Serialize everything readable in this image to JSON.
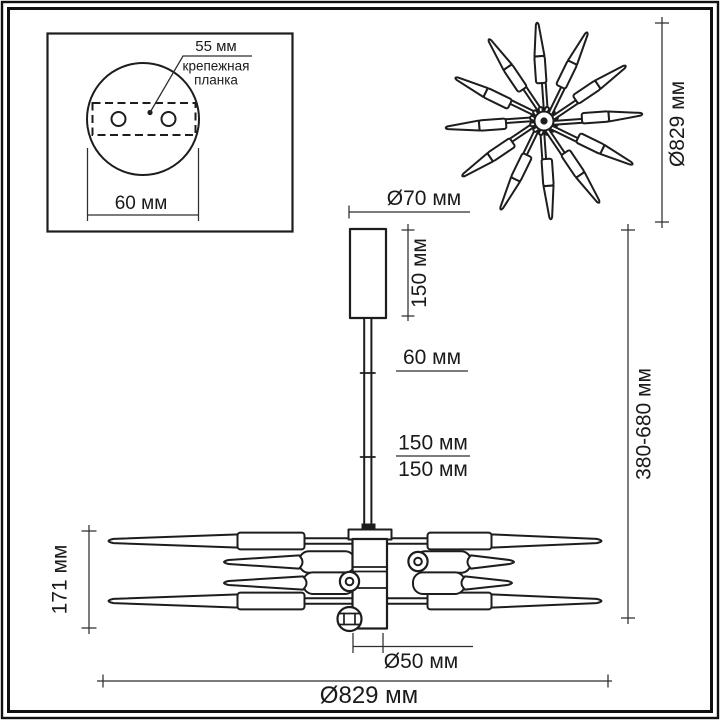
{
  "colors": {
    "ink": "#1d1d1d",
    "dimension_line": "#2e2e2e",
    "background": "#ffffff"
  },
  "inset": {
    "hole_spacing": "55 мм",
    "note": [
      "крепежная",
      "планка"
    ],
    "plate_width": "60 мм"
  },
  "top_view": {
    "diameter": "Ø829 мм"
  },
  "side_view": {
    "canopy_diameter": "Ø70 мм",
    "canopy_height": "150 мм",
    "rod_segment_1": "60 мм",
    "rod_segment_2": "150 мм",
    "rod_segment_3": "150 мм",
    "height_range": "380-680 мм",
    "fixture_height": "171 мм",
    "hub_diameter": "Ø50 мм",
    "fixture_diameter": "Ø829 мм"
  }
}
